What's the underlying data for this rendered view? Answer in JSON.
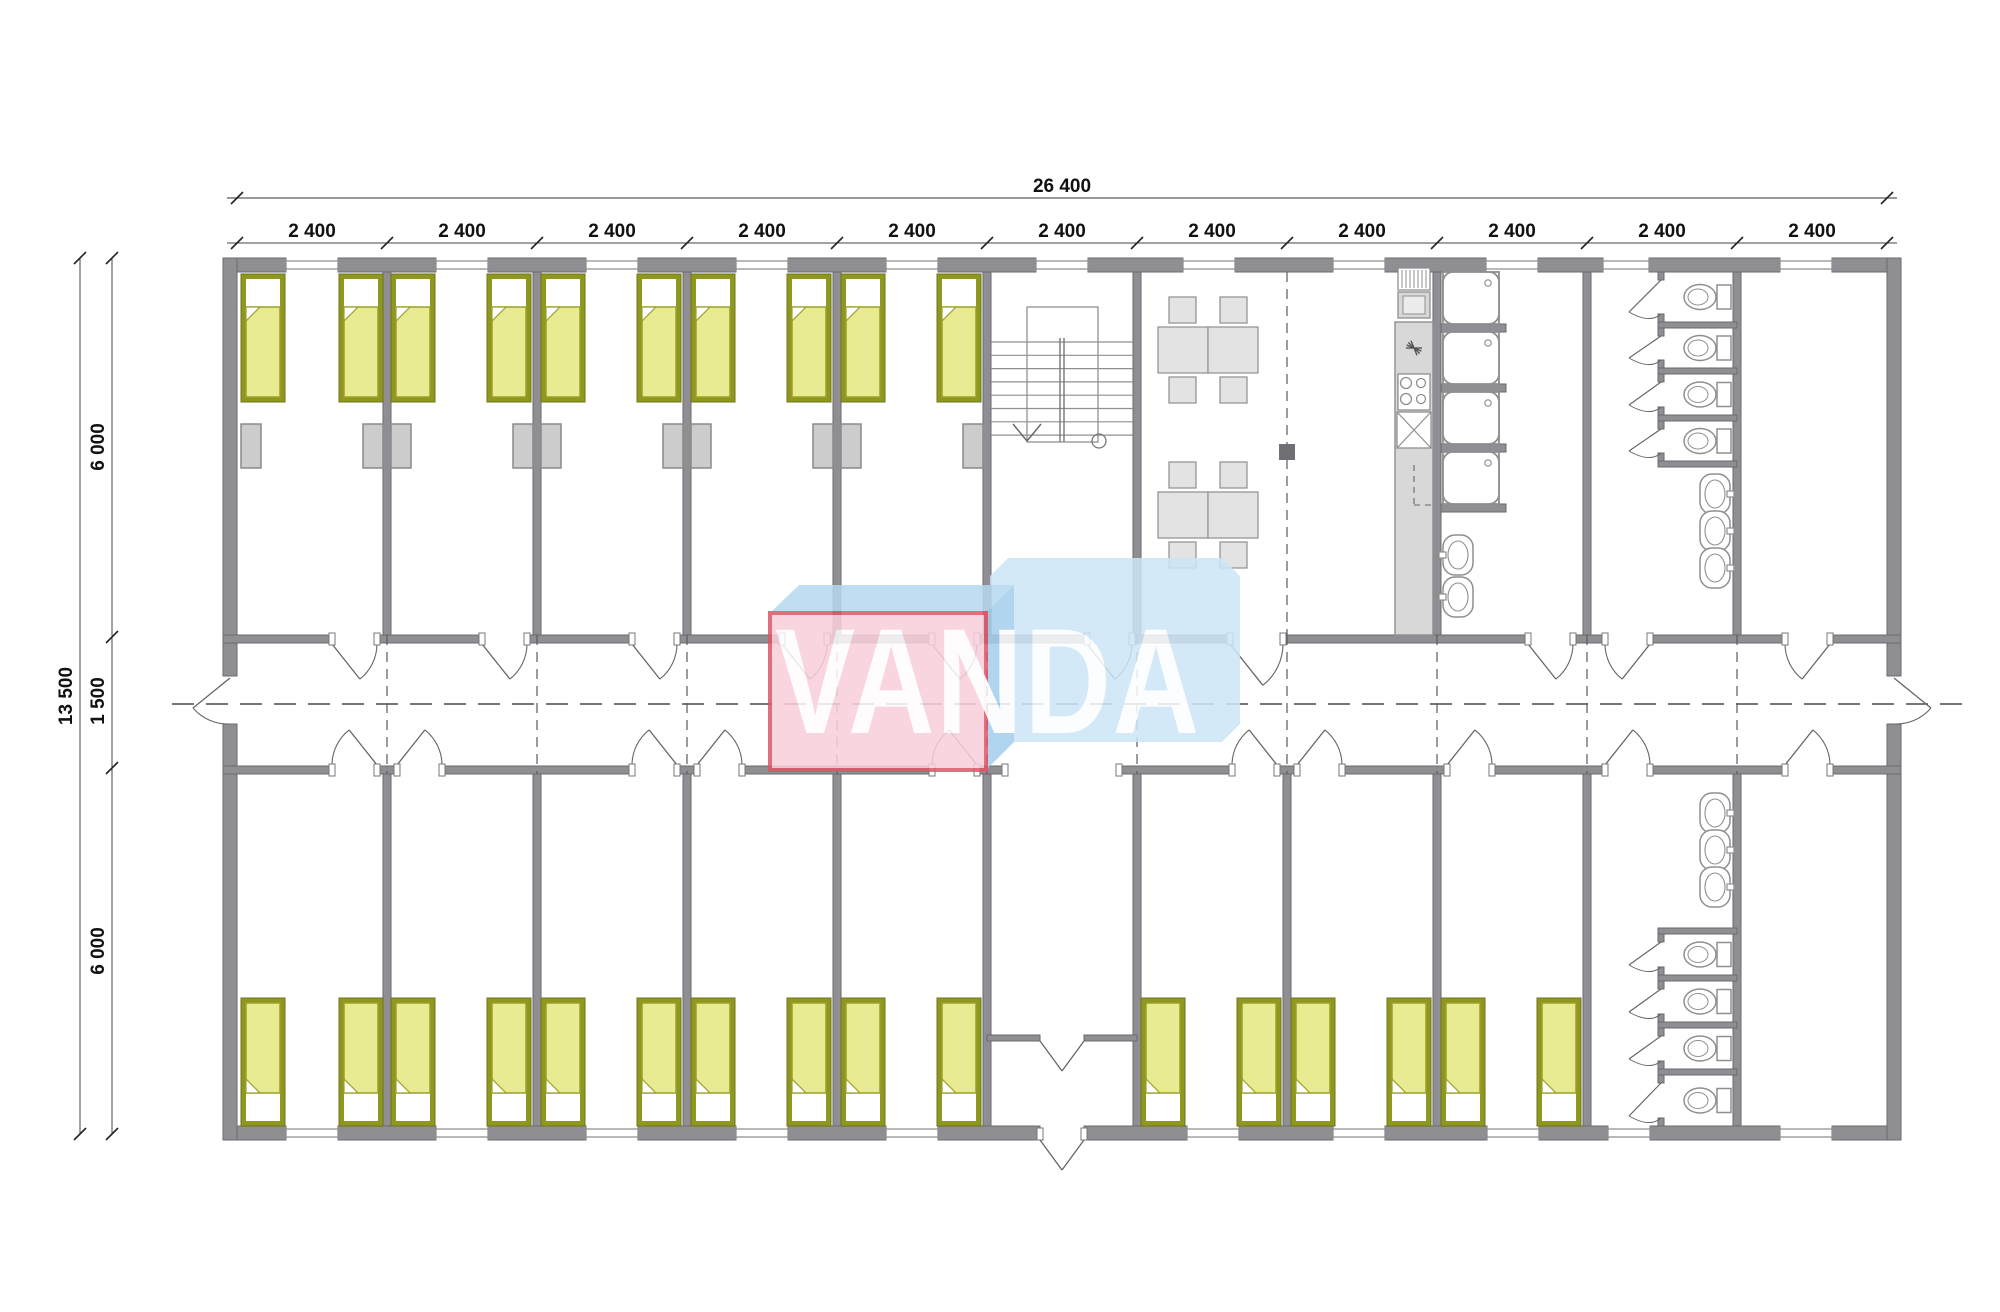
{
  "title": "modular building floor plan",
  "dimensions": {
    "total_width_label": "26 400",
    "module_label": "2 400",
    "module_count": 11,
    "total_height_label": "13 500",
    "upper_depth_label": "6 000",
    "corridor_label": "1 500",
    "lower_depth_label": "6 000"
  },
  "logo": {
    "text": "VANDA",
    "front_color": "#f9d0da",
    "front_border": "#dd5768",
    "top_color": "#b6d9f0",
    "fold_color": "#a5cfec",
    "arrow_color": "#cde6f7",
    "text_color": "#ffffff"
  },
  "colors": {
    "wall": "#8e8e93",
    "wall_edge": "#6a6a6f",
    "bed_frame": "#8f971f",
    "bed_blanket": "#e9eb92",
    "bed_blanket_edge": "#9aa12b",
    "furniture_fill": "#e3e3e3",
    "fixture_line": "#8f8f8f",
    "counter": "#d8d8d8",
    "nightstand": "#cccccc",
    "dash": "#4a4a4a",
    "dim_line": "#555555",
    "dim_text": "#111111"
  },
  "plan": {
    "ext": {
      "left": 223,
      "right": 1901,
      "top": 258,
      "bottom": 1126,
      "t": 14
    },
    "corridor": {
      "topWallY": 635,
      "botWallY": 766,
      "wallT": 8,
      "axisY": 704,
      "axisX1": 172,
      "axisX2": 1962
    },
    "grid": {
      "x0": 237,
      "step": 150,
      "n": 12
    },
    "innerWallsTop": [
      387,
      537,
      687,
      837,
      987,
      1137,
      1437,
      1587,
      1737
    ],
    "innerWallsBottom": [
      387,
      537,
      687,
      837,
      987,
      1137,
      1287,
      1437,
      1587,
      1737
    ],
    "windowsTop": [
      [
        286,
        338
      ],
      [
        436,
        488
      ],
      [
        586,
        638
      ],
      [
        736,
        788
      ],
      [
        886,
        938
      ],
      [
        1036,
        1088
      ],
      [
        1183,
        1235
      ],
      [
        1333,
        1385
      ],
      [
        1486,
        1538
      ],
      [
        1603,
        1649
      ],
      [
        1780,
        1832
      ]
    ],
    "windowsBottom": [
      [
        286,
        338
      ],
      [
        436,
        488
      ],
      [
        586,
        638
      ],
      [
        736,
        788
      ],
      [
        886,
        938
      ],
      [
        1187,
        1239
      ],
      [
        1333,
        1385
      ],
      [
        1487,
        1539
      ],
      [
        1608,
        1650
      ],
      [
        1780,
        1832
      ]
    ],
    "doorsTop": [
      [
        332,
        377,
        "L"
      ],
      [
        482,
        527,
        "L"
      ],
      [
        632,
        677,
        "L"
      ],
      [
        782,
        827,
        "L"
      ],
      [
        932,
        977,
        "L"
      ],
      [
        1087,
        1132,
        "L"
      ],
      [
        1230,
        1283,
        "L"
      ],
      [
        1528,
        1573,
        "L"
      ],
      [
        1605,
        1650,
        "R"
      ],
      [
        1785,
        1830,
        "R"
      ]
    ],
    "doorsBottom": [
      [
        332,
        377,
        "R"
      ],
      [
        397,
        442,
        "L"
      ],
      [
        632,
        677,
        "R"
      ],
      [
        697,
        742,
        "L"
      ],
      [
        932,
        977,
        "R"
      ],
      [
        1232,
        1277,
        "R"
      ],
      [
        1297,
        1342,
        "L"
      ],
      [
        1447,
        1492,
        "L"
      ],
      [
        1605,
        1650,
        "L"
      ],
      [
        1785,
        1830,
        "L"
      ]
    ],
    "corridorBottomOpening": [
      1005,
      1119
    ],
    "sideDoorGap": [
      676,
      724
    ],
    "vestibule": {
      "wallY": 1035,
      "x1": 987,
      "x2": 1137,
      "doorA": 1040,
      "doorB": 1084
    },
    "bed": {
      "w": 44,
      "h": 128,
      "yTop": 274,
      "yBottom": 998
    },
    "bedsTop": [
      241,
      339,
      391,
      487,
      541,
      637,
      691,
      787,
      841,
      937
    ],
    "bedsBottom": [
      241,
      339,
      391,
      487,
      541,
      637,
      691,
      787,
      841,
      937,
      1141,
      1237,
      1291,
      1387,
      1441,
      1537
    ],
    "nightstand": {
      "y": 424,
      "w": 20,
      "h": 44
    },
    "nightstands": [
      241,
      363,
      391,
      513,
      541,
      663,
      691,
      813,
      841,
      963
    ],
    "diningGroups": [
      {
        "x": 1158,
        "y": 297
      },
      {
        "x": 1158,
        "y": 462
      }
    ],
    "stairs": {
      "roomX1": 991,
      "roomX2": 1133,
      "outline": [
        1027,
        307,
        71,
        135
      ],
      "treadY0": 342,
      "treadDY": 13.3,
      "treadN": 8,
      "railX": [
        1060,
        1064
      ],
      "railY": [
        338,
        442
      ],
      "arrowCX": 1027,
      "arrowY": [
        424,
        441
      ],
      "circle": [
        1099,
        441,
        7
      ]
    },
    "kitchen": {
      "vent": [
        1398,
        268,
        32,
        22
      ],
      "heater": [
        1398,
        292,
        32,
        26
      ],
      "counter": [
        1395,
        322,
        38,
        313
      ],
      "star": [
        1414,
        348
      ],
      "hob": [
        1398,
        374,
        32,
        36
      ],
      "burners": [
        [
          1406,
          383,
          5.5
        ],
        [
          1421,
          383,
          4.5
        ],
        [
          1406,
          399,
          5.5
        ],
        [
          1421,
          399,
          4.5
        ]
      ],
      "sink": [
        1397,
        412,
        34,
        36
      ],
      "dashDetail": [
        1414,
        465,
        505
      ]
    },
    "showers": {
      "trayX": 1443,
      "trayW": 56,
      "trayH": 52,
      "trayYs": [
        272,
        332,
        392,
        452
      ],
      "stubYs": [
        324,
        384,
        444,
        504
      ],
      "stubX1": 1441,
      "stubX2": 1506,
      "basins": [
        [
          1457,
          555
        ],
        [
          1457,
          597
        ]
      ]
    },
    "toiletsTop": {
      "frontX": 1658,
      "wallX": 1733,
      "divYs": [
        322,
        368,
        415,
        461
      ],
      "stalls": [
        [
          272,
          322
        ],
        [
          328,
          368
        ],
        [
          374,
          415
        ],
        [
          421,
          461
        ]
      ],
      "basins": [
        [
          1714,
          494
        ],
        [
          1714,
          531
        ],
        [
          1714,
          568
        ]
      ]
    },
    "toiletsBottom": {
      "frontX": 1658,
      "wallX": 1733,
      "divYs": [
        928,
        975,
        1022,
        1069
      ],
      "stalls": [
        [
          934,
          975
        ],
        [
          981,
          1022
        ],
        [
          1028,
          1069
        ],
        [
          1075,
          1126
        ]
      ],
      "basins": [
        [
          1714,
          813
        ],
        [
          1714,
          850
        ],
        [
          1714,
          887
        ]
      ]
    },
    "joints": [
      387,
      537,
      687,
      837,
      987,
      1137,
      1287,
      1437,
      1587,
      1737
    ],
    "diningJoint": 1287,
    "column": [
      1279,
      444,
      16,
      16
    ]
  },
  "dims_layout": {
    "topTotalY": 198,
    "topModuleY": 243,
    "labelTotalX": 1062,
    "leftTotalX": 80,
    "leftSegX": 112,
    "leftTicks": [
      258,
      637,
      768,
      1134
    ],
    "upperLabelY": 447,
    "corridorLabelY": 701,
    "lowerLabelY": 951,
    "totalHeightLabelY": 696
  }
}
